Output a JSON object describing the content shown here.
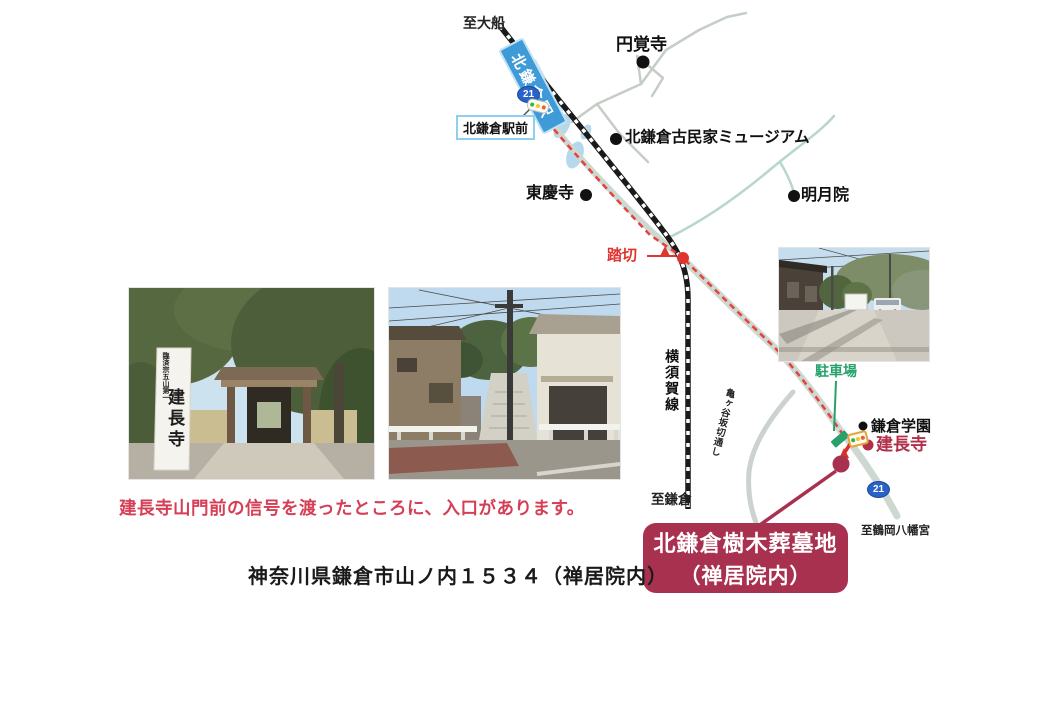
{
  "map": {
    "to_ofuna": "至大船",
    "station": "北鎌倉駅",
    "route_number": "21",
    "ekimae": "北鎌倉駅前",
    "engakuji": "円覚寺",
    "museum": "北鎌倉古民家ミュージアム",
    "tokeiji": "東慶寺",
    "meigetsuin": "明月院",
    "fumikiri": "踏切",
    "yokosuka_line": "横須賀線",
    "parking": "駐車場",
    "kamakura_gakuen": "鎌倉学園",
    "kenchoji": "建長寺",
    "kamegayatsu_pass": "亀ヶ谷坂切通し",
    "to_kamakura": "至鎌倉",
    "to_hachimangu": "至鶴岡八幡宮",
    "destination_badge": {
      "line1": "北鎌倉樹木葬墓地",
      "line2": "（禅居院内）"
    }
  },
  "photos": {
    "gate": {
      "pillar_title": "建長寺",
      "pillar_sub": "臨済宗五山第一"
    }
  },
  "caption": "建長寺山門前の信号を渡ったところに、入口があります。",
  "address": "神奈川県鎌倉市山ノ内１５３４（禅居院内）",
  "colors": {
    "route_red": "#e8403a",
    "destination_red": "#a93150",
    "station_blue": "#3f9bd8",
    "parking_green": "#28a06a",
    "kenchoji_red": "#b0304a",
    "road_gray": "#ccd8d0"
  }
}
